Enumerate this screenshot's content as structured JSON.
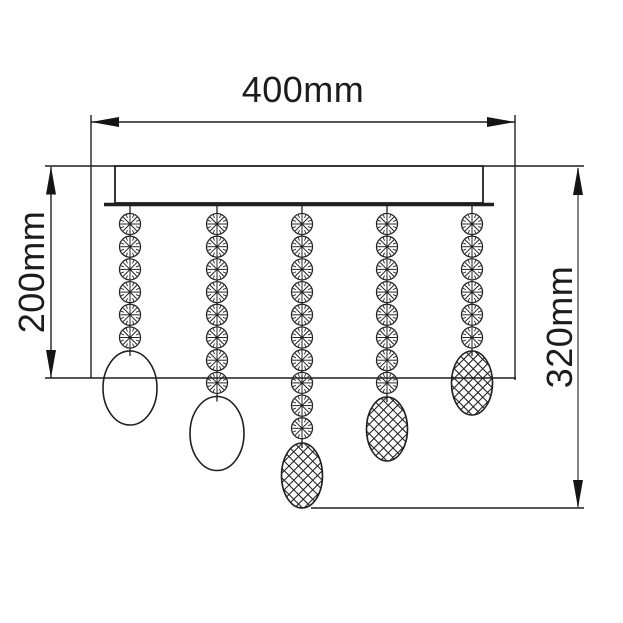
{
  "meta": {
    "title": "Crystal drop ceiling light fitting - dimension diagram",
    "style": "monochrome technical line drawing",
    "background": "#ffffff",
    "ink": "#1f1f1f",
    "secondary_line": "#666666"
  },
  "dimensions": {
    "width": {
      "label": "400mm",
      "orientation": "horizontal",
      "measures": "ceiling plate width"
    },
    "left_drop": {
      "label": "200mm",
      "orientation": "vertical",
      "measures": "drop to shortest pendants"
    },
    "right_drop": {
      "label": "320mm",
      "orientation": "vertical",
      "measures": "overall drop to longest pendant"
    }
  },
  "fixture": {
    "canopy": "flush ceiling plate with trim bar",
    "strand_count": 5,
    "strands": [
      {
        "index": 1,
        "beads": 6,
        "pendant": "plain-oval"
      },
      {
        "index": 2,
        "beads": 8,
        "pendant": "plain-oval"
      },
      {
        "index": 3,
        "beads": 10,
        "pendant": "faceted-oval"
      },
      {
        "index": 4,
        "beads": 8,
        "pendant": "faceted-oval"
      },
      {
        "index": 5,
        "beads": 6,
        "pendant": "faceted-oval"
      }
    ],
    "bead_style": "round faceted crystal bead (circle with radial facet spokes)",
    "pendant_styles": {
      "plain-oval": "smooth oval drop",
      "faceted-oval": "crosshatched faceted oval drop"
    }
  }
}
